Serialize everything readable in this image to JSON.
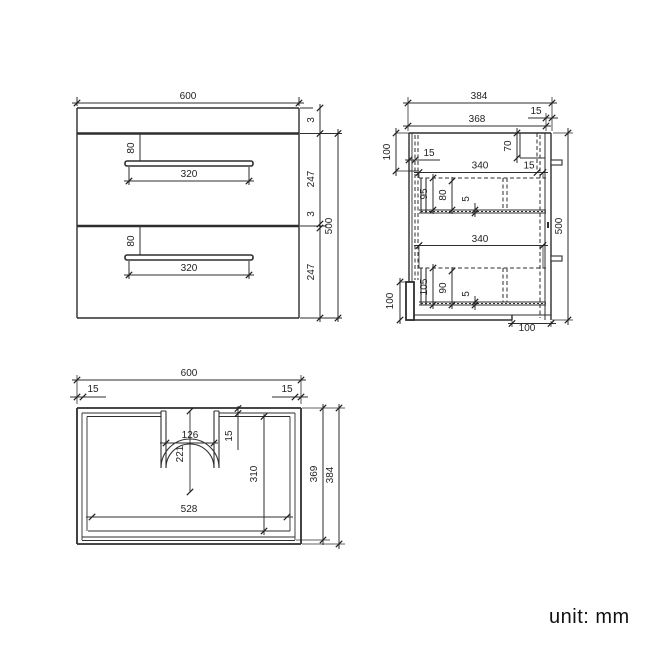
{
  "unit_note": "unit: mm",
  "drawing_title": "vanity-cabinet-technical-drawing",
  "views": {
    "front_view": {
      "name": "front elevation",
      "dim_labels": [
        "600",
        "80",
        "320",
        "80",
        "320",
        "3",
        "247",
        "3",
        "247",
        "500"
      ]
    },
    "side_view": {
      "name": "side section",
      "dim_labels": [
        "384",
        "15",
        "368",
        "100",
        "15",
        "70",
        "340",
        "15",
        "95",
        "80",
        "5",
        "340",
        "105",
        "90",
        "5",
        "100",
        "100",
        "500"
      ]
    },
    "top_view": {
      "name": "top plan with basin cutout",
      "dim_labels": [
        "600",
        "15",
        "15",
        "126",
        "221",
        "15",
        "310",
        "528",
        "369",
        "384"
      ]
    }
  }
}
